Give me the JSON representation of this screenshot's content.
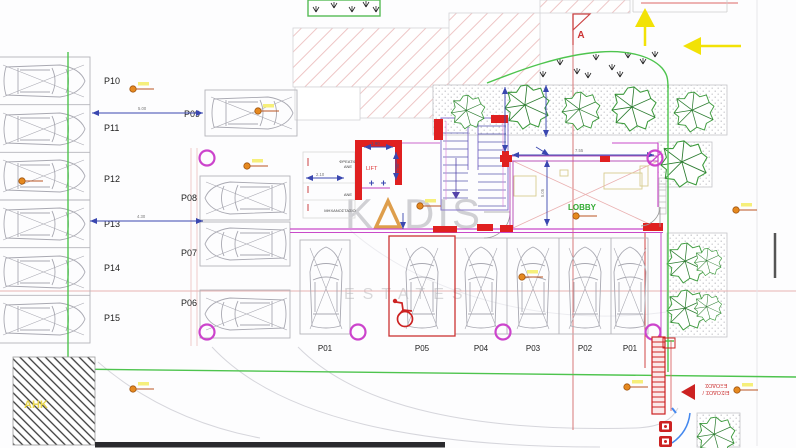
{
  "watermark": {
    "name": "KADIS",
    "part1": "K",
    "part2": "DIS",
    "sub": "ESTATES"
  },
  "stalls": {
    "left": [
      "P10",
      "P11",
      "P12",
      "P13",
      "P14",
      "P15"
    ],
    "p09": "P09",
    "center": [
      "P08",
      "P07",
      "P06"
    ],
    "bottom": [
      "P01",
      "P05",
      "P04",
      "P03",
      "P02",
      "P01"
    ]
  },
  "labels": {
    "lift": "LIFT",
    "lobby": "LOBBY",
    "ahk": "ΑΗΚ",
    "section_a": "A",
    "entrance_line1": "ΕΙΣΟΔΟΣ /",
    "entrance_line2": "ΕΞΟΔΟΣ",
    "shaft_line1": "ΦΡΕΑΤΙΟ",
    "shaft_line2": "ΑΝΕ",
    "vent": "ΑΝΕ",
    "machine": "ΜΗΧΑΝΟΣΤΑΣΙΟ"
  },
  "dimensions": {
    "d_p09": "5.00",
    "d_p13": "4.30",
    "lift_w": "1.90",
    "lift_d": "1.90",
    "shaft_w": "2.10",
    "lobby_w": "7.55",
    "lobby_d": "5.05"
  },
  "colors": {
    "wall_red": "#d42222",
    "dim_blue": "#3a47b0",
    "site_green": "#4ec44e",
    "wall_magenta": "#c94ac9",
    "hatch_pink": "#eec6c6",
    "arrow_yellow": "#f2e206",
    "accent_orange": "#df8a26",
    "watermark_gray": "#c9c9cd"
  }
}
